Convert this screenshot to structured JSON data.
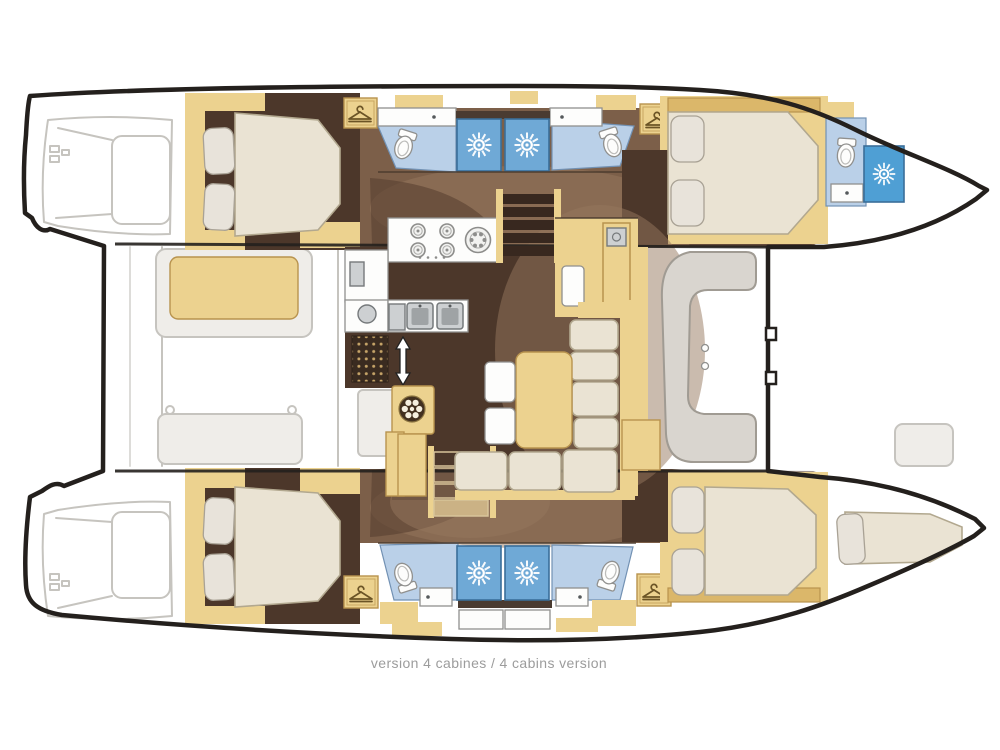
{
  "caption": {
    "text": "version 4 cabines / 4 cabins version"
  },
  "palette": {
    "outline": "#24201d",
    "sketch": "#c6c4bf",
    "sketch_fill": "#efede9",
    "wood": "#ecd28f",
    "wood_dark": "#b8934e",
    "wood_deep": "#dbb76a",
    "floor_dark": "#4c372a",
    "floor_mid": "#7c5f49",
    "floor_light": "#96785e",
    "shadow": "#533c2d",
    "bed": "#eae3d3",
    "bed_border": "#b2a88f",
    "pillow": "#e8e3da",
    "pillow_border": "#a9a295",
    "bath": "#bad0e8",
    "bath_border": "#7291b3",
    "shower": "#6fa9d6",
    "shower_deep": "#4f9fd4",
    "shower_border": "#3a6e99",
    "fixture": "#fdfdfc",
    "fixture_border": "#90908e",
    "steel": "#cdd0d2",
    "seat": "#d9d5cf",
    "seat_border": "#a09b93",
    "step": "#38281f",
    "caption": "#9c9c9c",
    "white": "#ffffff"
  }
}
